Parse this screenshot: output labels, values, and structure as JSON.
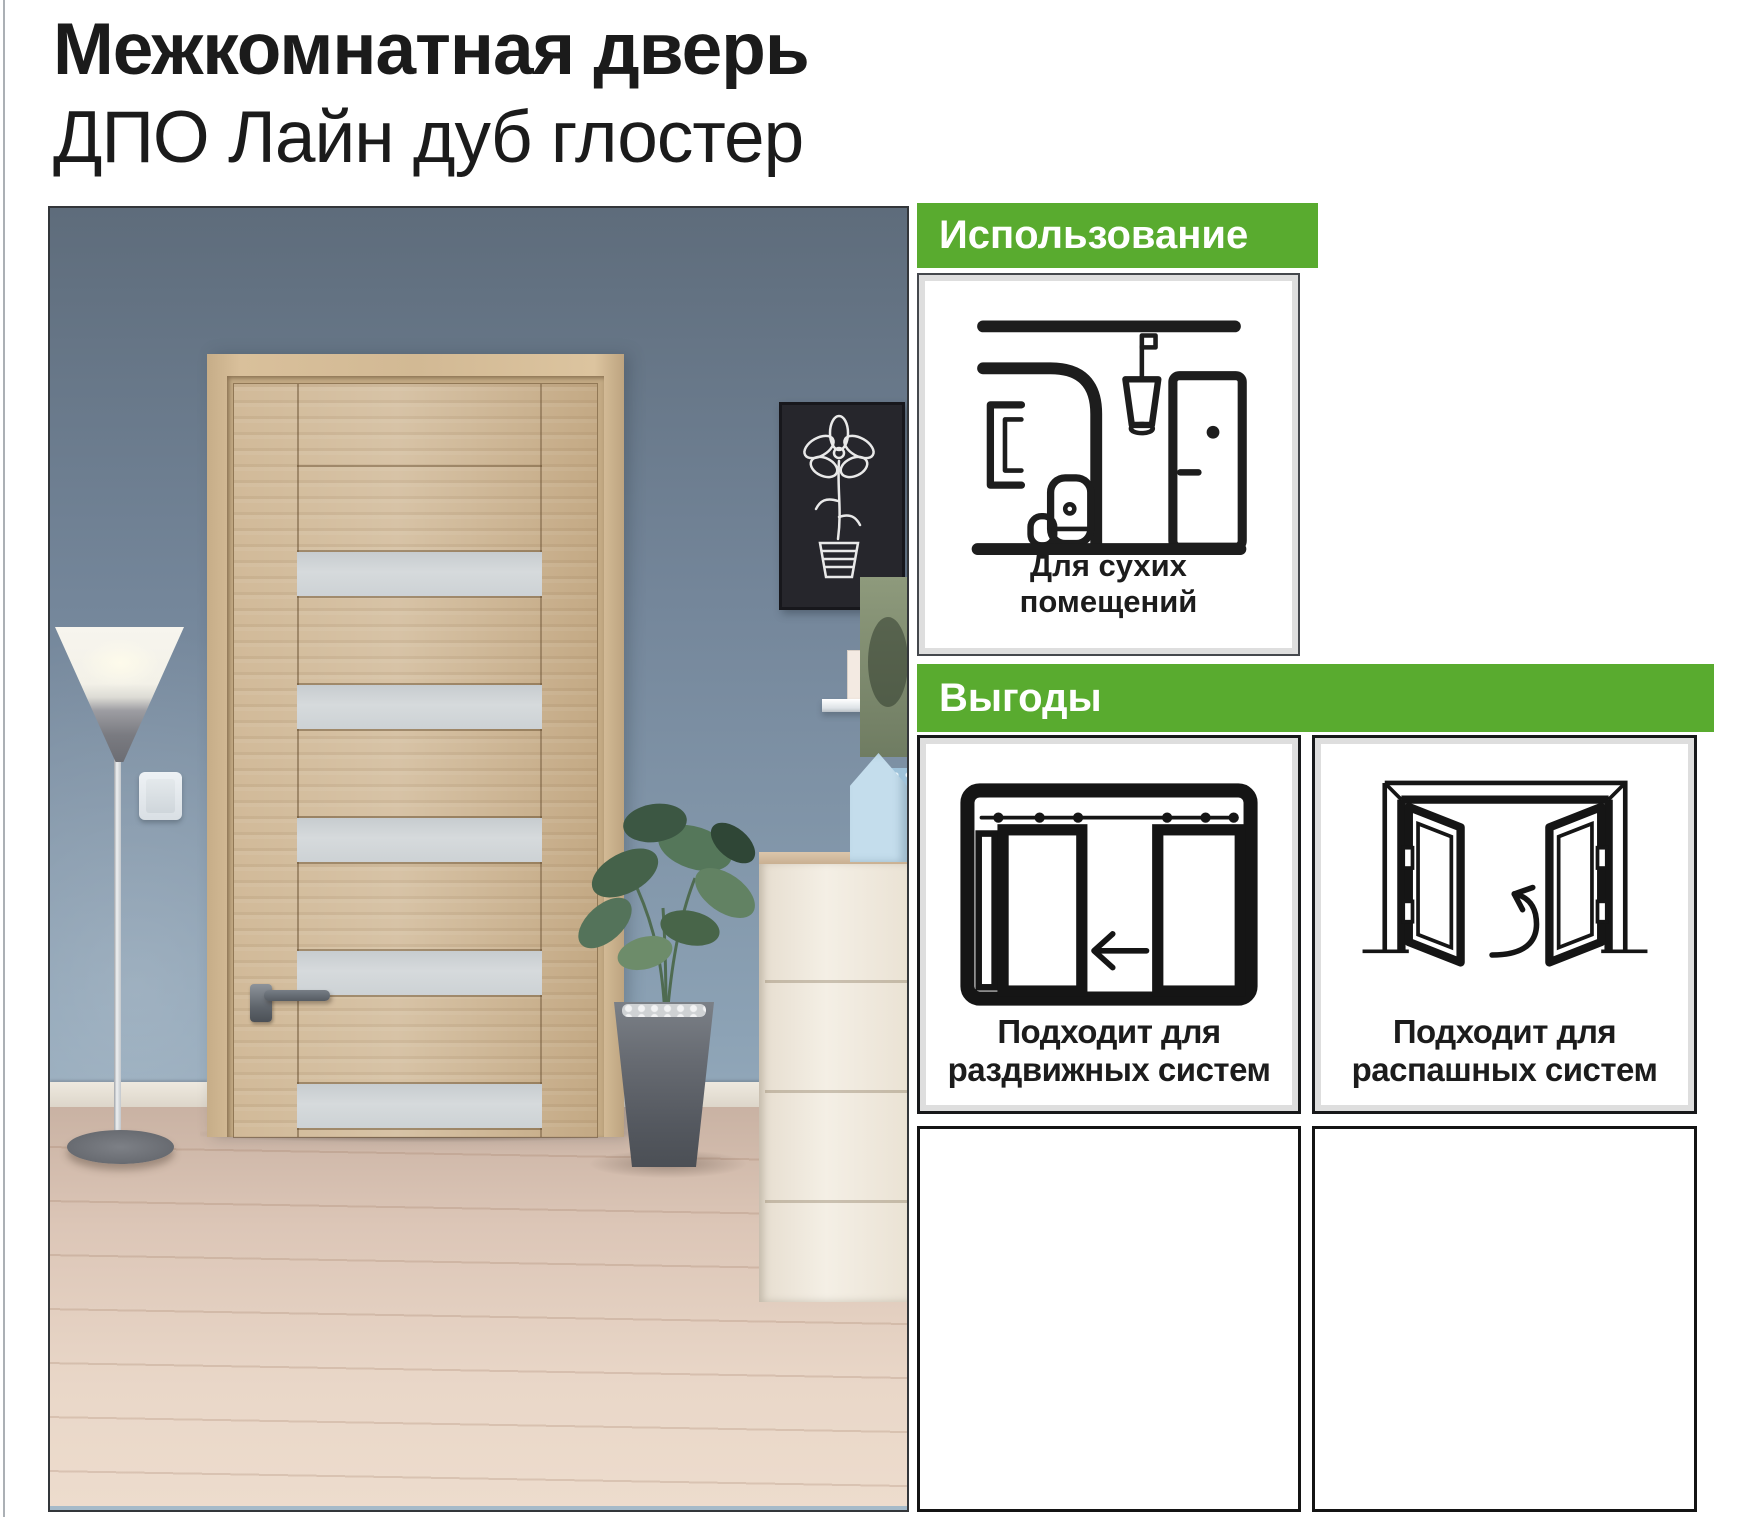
{
  "page": {
    "title_line1": "Межкомнатная дверь",
    "title_line2": "ДПО Лайн дуб глостер"
  },
  "colors": {
    "accent_green": "#59ab2f",
    "ink": "#1b1b1b",
    "glass_insert": "#d0d4d7",
    "door_wood": "#ccb28d",
    "wall_blue": "#7d93a6"
  },
  "usage_section": {
    "header": "Использование",
    "card": {
      "icon": "dry-rooms-interior-icon",
      "caption": [
        "Для сухих",
        "помещений"
      ]
    }
  },
  "benefits_section": {
    "header": "Выгоды",
    "cards": [
      {
        "icon": "sliding-doors-system-icon",
        "caption": [
          "Подходит для",
          "раздвижных систем"
        ]
      },
      {
        "icon": "swing-doors-system-icon",
        "caption": [
          "Подходит для",
          "распашных систем"
        ]
      }
    ]
  }
}
